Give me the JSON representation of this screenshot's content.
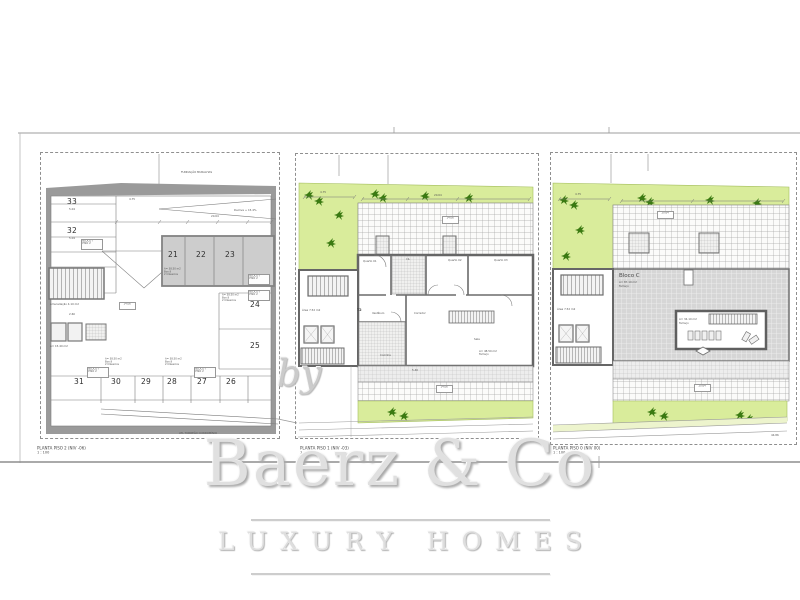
{
  "watermark": {
    "by": "by",
    "brand": "Baerz & Co",
    "tagline": "LUXURY HOMES"
  },
  "plans": [
    {
      "title": "PLANTA PISO 2 (NIV -06)",
      "scale": "1 : 100",
      "top_note": "FUNDAÇÃO MURALHAS",
      "boundary_note": "ATL TORREÃO CONDOMÍNIO",
      "ramp_note": "Declive + 15.4%",
      "block_tag": "BLOCO I",
      "block_tag2": "PISO 2",
      "stall_note": "A= 38.50 m2",
      "stall_note2": "Box 9",
      "stall_note3": "2 Clássicos",
      "core_note": "Arrecadação 4.10 m2",
      "core_note2": "A= 15.40 m2",
      "spaces": {
        "s21": "21",
        "s22": "22",
        "s23": "23",
        "s24": "24",
        "s25": "25",
        "s26": "26",
        "s27": "27",
        "s28": "28",
        "s29": "29",
        "s30": "30",
        "s31": "31",
        "s32": "32",
        "s33": "33"
      },
      "dims": {
        "d1": "5.04",
        "d2": "5.04",
        "d3": "20.64",
        "d4": "14.06",
        "d5": "2.60",
        "d6": "4.75"
      }
    },
    {
      "title": "PLANTA PISO 1 (NIV -03)",
      "scale": "1 : 100",
      "unit": "T2",
      "area_note": "Área 7.52 m2",
      "terrace_note": "A= 48.50 m2",
      "terrace_note2": "Terraço",
      "rooms": {
        "quarto1": "Quarto 01",
        "is": "I.S.",
        "quarto2": "Quarto 02",
        "quarto3": "Quarto 03",
        "vestibulo": "Vestíbulo",
        "corredor": "Corredor",
        "cozinha": "Cozinha",
        "sala": "Sala"
      },
      "dims": {
        "d1": "4.75",
        "d2": "20.64",
        "d3": "14.06",
        "d4": "5.40"
      }
    },
    {
      "title": "PLANTA PISO 0 (NIV 00)",
      "scale": "1 : 100",
      "bloco": "Bloco C",
      "bloco_area": "A= 87.10 m2",
      "bloco_use": "Terraço",
      "area_note": "Área 7.52 m2",
      "courtyard_note": "A= 34.10 m2",
      "courtyard_note2": "Terraço",
      "dims": {
        "d1": "4.75",
        "d2": "20.64",
        "d3": "44.86"
      }
    }
  ],
  "colors": {
    "grass": "#d9ec9b",
    "plant": "#3b7a12",
    "wall": "#9a9a9a",
    "paving": "#d6d6d6",
    "road_tint": "#edf4cd"
  }
}
